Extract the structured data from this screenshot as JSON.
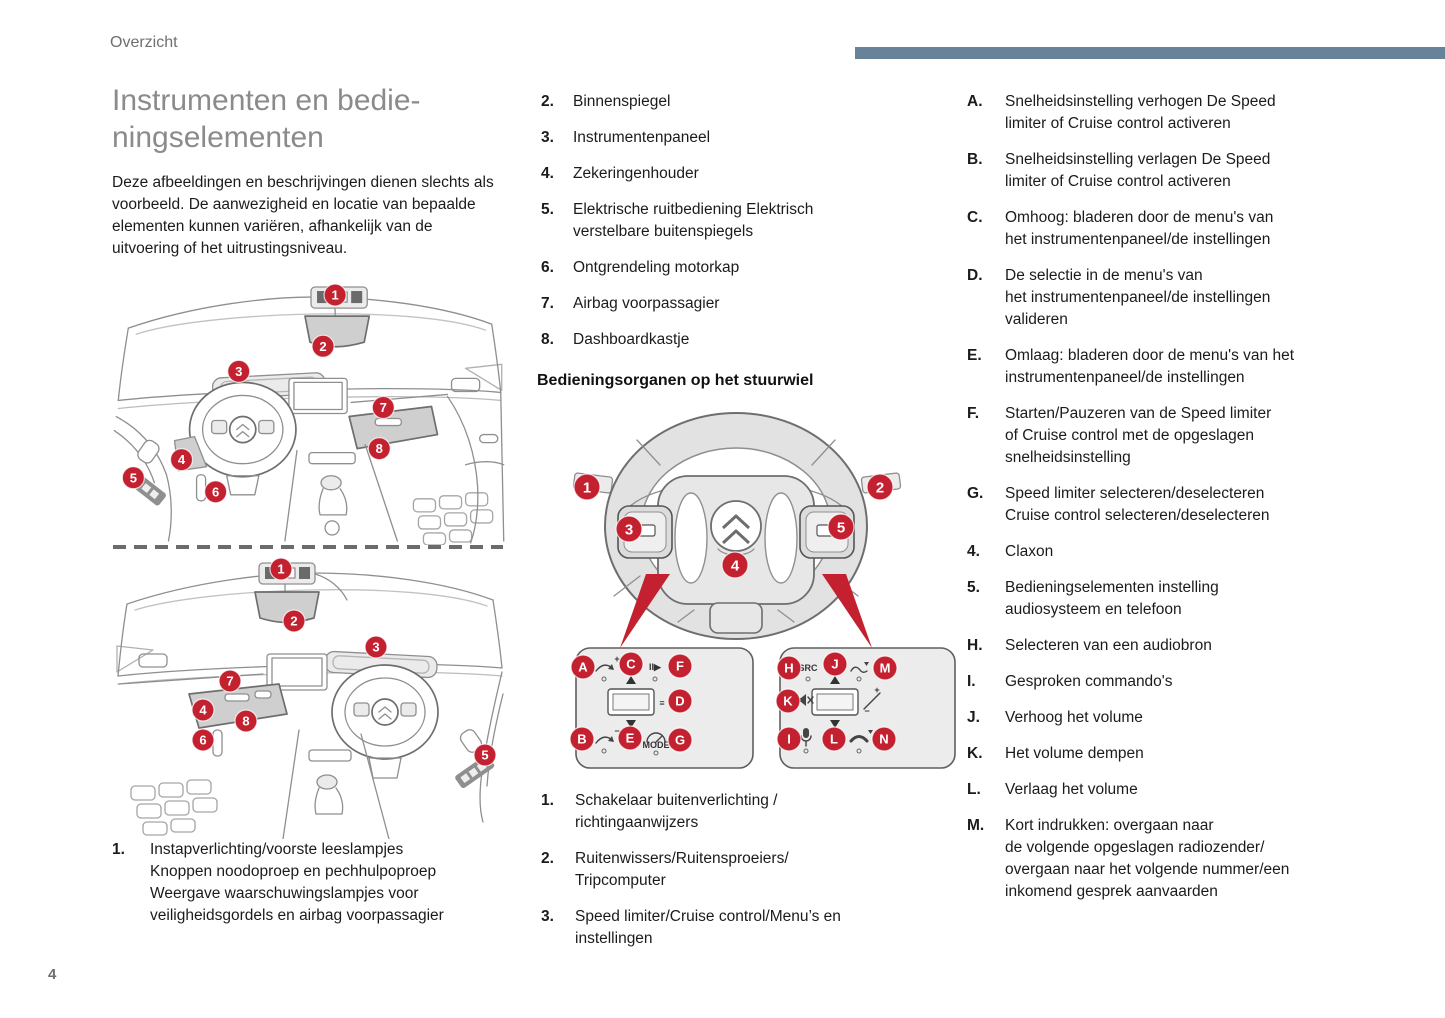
{
  "header": {
    "section": "Overzicht"
  },
  "footer": {
    "page_number": "4"
  },
  "colors": {
    "accent_red": "#c32130",
    "accent_bar_blue": "#68829a",
    "title_gray": "#8b8b8b",
    "text": "#1b1b1b"
  },
  "left": {
    "title": "Instrumenten en bedie-\nningselementen",
    "intro": "Deze afbeeldingen en beschrijvingen dienen slechts als voorbeeld. De aanwezigheid en locatie van bepaalde elementen kunnen variëren, afhankelijk van de uitvoering of het uitrustingsniveau.",
    "item1": {
      "num": "1.",
      "text": "Instapverlichting/voorste leeslampjes\nKnoppen noodoproep en pechhulpoproep\nWeergave waarschuwingslampjes voor\nveiligheidsgordels en airbag voorpassagier"
    }
  },
  "middle": {
    "items": [
      {
        "num": "2.",
        "text": "Binnenspiegel"
      },
      {
        "num": "3.",
        "text": "Instrumentenpaneel"
      },
      {
        "num": "4.",
        "text": "Zekeringenhouder"
      },
      {
        "num": "5.",
        "text": "Elektrische ruitbediening Elektrisch\nverstelbare buitenspiegels"
      },
      {
        "num": "6.",
        "text": "Ontgrendeling motorkap"
      },
      {
        "num": "7.",
        "text": "Airbag voorpassagier"
      },
      {
        "num": "8.",
        "text": "Dashboardkastje"
      }
    ],
    "heading": "Bedieningsorganen op het stuurwiel",
    "bottom_items": [
      {
        "num": "1.",
        "text": "Schakelaar buitenverlichting /\nrichtingaanwijzers"
      },
      {
        "num": "2.",
        "text": "Ruitenwissers/Ruitensproeiers/\nTripcomputer"
      },
      {
        "num": "3.",
        "text": "Speed limiter/Cruise control/Menu’s en\ninstellingen"
      }
    ]
  },
  "right": {
    "items": [
      {
        "num": "A.",
        "text": "Snelheidsinstelling verhogen De Speed\nlimiter of Cruise control activeren"
      },
      {
        "num": "B.",
        "text": "Snelheidsinstelling verlagen De Speed\nlimiter of Cruise control activeren"
      },
      {
        "num": "C.",
        "text": "Omhoog: bladeren door de menu's van\nhet instrumentenpaneel/de instellingen"
      },
      {
        "num": "D.",
        "text": "De selectie in de menu's van\nhet instrumentenpaneel/de instellingen\nvalideren"
      },
      {
        "num": "E.",
        "text": "Omlaag: bladeren door de menu's van het\ninstrumentenpaneel/de instellingen"
      },
      {
        "num": "F.",
        "text": "Starten/Pauzeren van de Speed limiter\nof Cruise control met de opgeslagen\nsnelheidsinstelling"
      },
      {
        "num": "G.",
        "text": "Speed limiter selecteren/deselecteren\nCruise control selecteren/deselecteren"
      },
      {
        "num": "4.",
        "text": "Claxon"
      },
      {
        "num": "5.",
        "text": "Bedieningselementen instelling\naudiosysteem en telefoon"
      },
      {
        "num": "H.",
        "text": "Selecteren van een audiobron"
      },
      {
        "num": "I.",
        "text": "Gesproken commando's"
      },
      {
        "num": "J.",
        "text": "Verhoog het volume"
      },
      {
        "num": "K.",
        "text": "Het volume dempen"
      },
      {
        "num": "L.",
        "text": "Verlaag het volume"
      },
      {
        "num": "M.",
        "text": "Kort indrukken: overgaan naar\nde volgende opgeslagen radiozender/\novergaan naar het volgende nummer/een\ninkomend gesprek aanvaarden"
      }
    ]
  },
  "dash1": {
    "markers": [
      "1",
      "2",
      "3",
      "4",
      "5",
      "6",
      "7",
      "8"
    ]
  },
  "dash2": {
    "markers": [
      "1",
      "2",
      "3",
      "4",
      "5",
      "6",
      "7",
      "8"
    ]
  },
  "wheel": {
    "markers": [
      "1",
      "2",
      "3",
      "4",
      "5"
    ],
    "panel_left": {
      "markers": [
        "A",
        "B",
        "C",
        "D",
        "E",
        "F",
        "G"
      ]
    },
    "panel_right": {
      "markers": [
        "H",
        "I",
        "J",
        "K",
        "L",
        "M",
        "N"
      ]
    }
  },
  "icons": {
    "pause_play": "II▶",
    "menu": "≡",
    "src": "SRC",
    "mode": "MODE",
    "speed_plus": "+",
    "speed_minus": "−",
    "vol_plus": "+",
    "vol_minus": "−"
  }
}
